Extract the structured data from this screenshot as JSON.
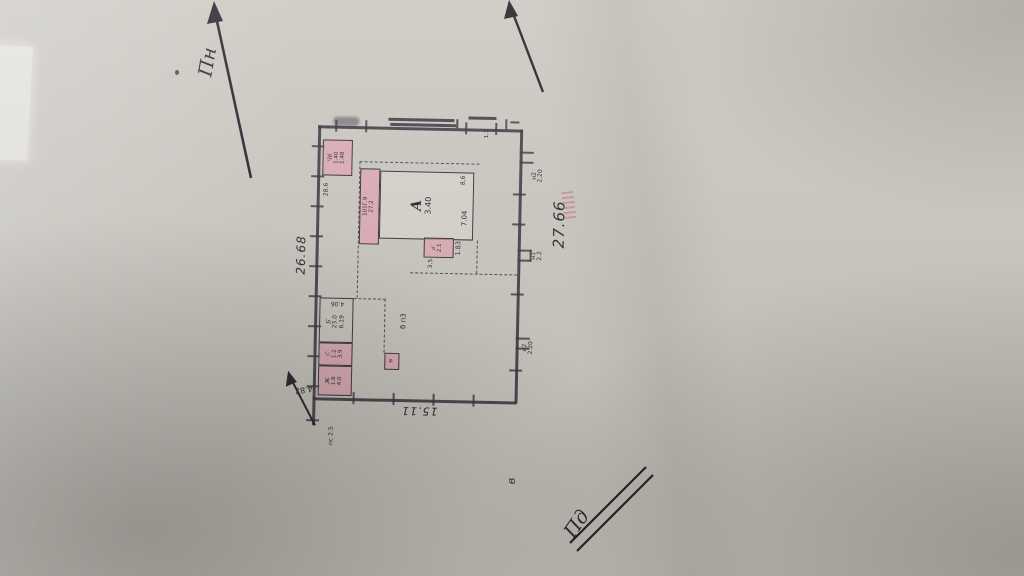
{
  "compass": {
    "north": "Пн",
    "south": "Пд",
    "page_letter": "в"
  },
  "dims": {
    "left_side": "26.68",
    "right_side": "27.66",
    "bottom_side": "15.11",
    "corner_arrow": "4.82",
    "corner_note": "пс 2.5",
    "top_mark": "1.1"
  },
  "gates": {
    "n1": {
      "name": "н1",
      "val": "2.2"
    },
    "n2_top": {
      "name": "н2",
      "val": "2.20"
    },
    "n2_bottom": {
      "name": "н2",
      "val": "2.20"
    }
  },
  "buildings": {
    "main": {
      "letter": "А",
      "area": "3.40",
      "width": "7.04",
      "height": "8,6",
      "side": "1.83",
      "under": "3.5"
    },
    "strip": {
      "line1": "101Г.9",
      "line2": "27.2"
    },
    "annex": {
      "letter": "а'",
      "value": "2.1"
    },
    "corner_shed": {
      "letter": "Чб",
      "v1": "1.40",
      "v2": "1.48",
      "note": "28.6"
    },
    "room_b": {
      "letter": "Б",
      "v1": "23.0",
      "v2": "6.19",
      "top": "4.06"
    },
    "room_c": {
      "letter": "С",
      "v1": "1.2",
      "v2": "3.9"
    },
    "room_zh": {
      "letter": "Ж",
      "v1": "1.6",
      "v2": "4.0"
    },
    "square": {
      "letter": "в"
    },
    "shed_note": "б п3"
  }
}
